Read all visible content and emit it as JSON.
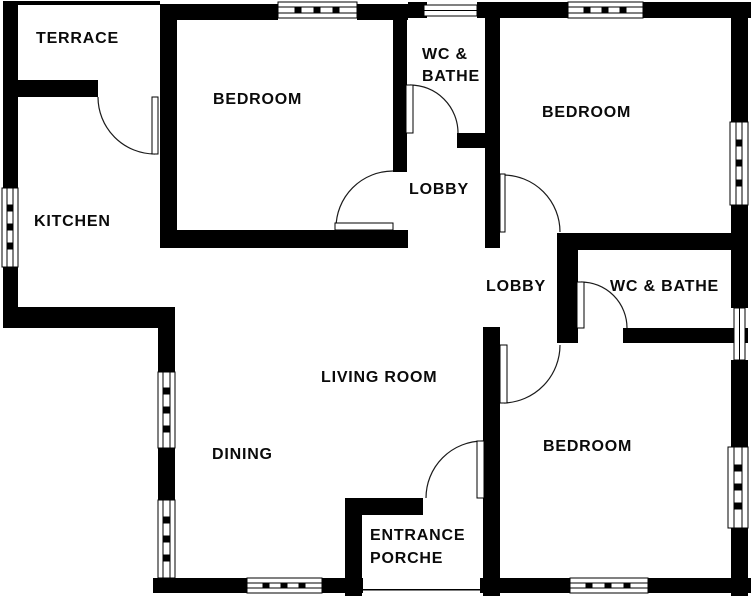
{
  "plan": {
    "type": "floor-plan",
    "colors": {
      "wall": "#000000",
      "background": "#ffffff",
      "text": "#0a0a0a",
      "door_arc": "#1a1a1a"
    },
    "features": {
      "doors": [
        "terrace-kitchen",
        "living-lobby-top",
        "wc-bathe-top",
        "bedroom-top-right",
        "wc-bathe-right",
        "bedroom-bottom-right",
        "entrance-front"
      ],
      "windows": [
        "bedroom-top-left-north",
        "wc-top-north",
        "bedroom-top-right-north",
        "kitchen-west",
        "bedroom-top-right-east",
        "wc-right-east",
        "bedroom-bottom-right-east",
        "dining-west-upper",
        "dining-west-lower",
        "dining-south",
        "bedroom-bottom-right-south"
      ]
    }
  },
  "rooms": {
    "terrace": {
      "label": "TERRACE"
    },
    "bedroom1": {
      "label": "BEDROOM"
    },
    "wc1": {
      "line1": "WC &",
      "line2": "BATHE"
    },
    "bedroom2": {
      "label": "BEDROOM"
    },
    "kitchen": {
      "label": "KITCHEN"
    },
    "lobby1": {
      "label": "LOBBY"
    },
    "lobby2": {
      "label": "LOBBY"
    },
    "wc2": {
      "label": "WC & BATHE"
    },
    "living": {
      "label": "LIVING ROOM"
    },
    "dining": {
      "label": "DINING"
    },
    "bedroom3": {
      "label": "BEDROOM"
    },
    "porch": {
      "line1": "ENTRANCE",
      "line2": "PORCHE"
    }
  }
}
